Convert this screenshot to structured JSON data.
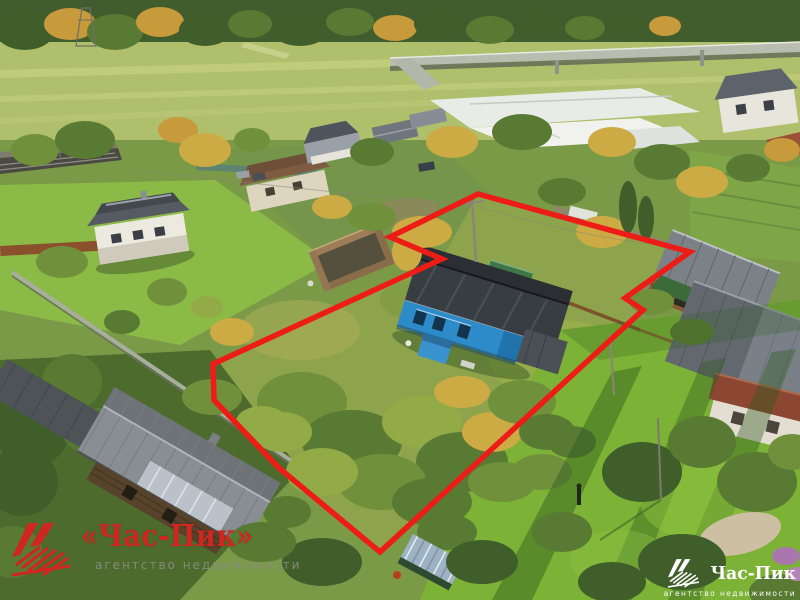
{
  "colors": {
    "outline_red": "#ed1c16",
    "logo_red": "#cf261f",
    "tagline_gray": "#8b8b82",
    "logo_white": "#ffffff",
    "house_blue": "#2e8bc9"
  },
  "outline": {
    "points": "478,194 690,252 625,298 643,310 380,552 279,468 214,400 213,364 442,259 390,237",
    "color": "#ed1c16",
    "width": 5.5
  },
  "watermarks": {
    "left": {
      "brand": "«Час-Пик»",
      "tagline": "агентство недвижимости"
    },
    "right": {
      "brand": "Час-Пик",
      "tagline": "агентство недвижимости"
    }
  }
}
